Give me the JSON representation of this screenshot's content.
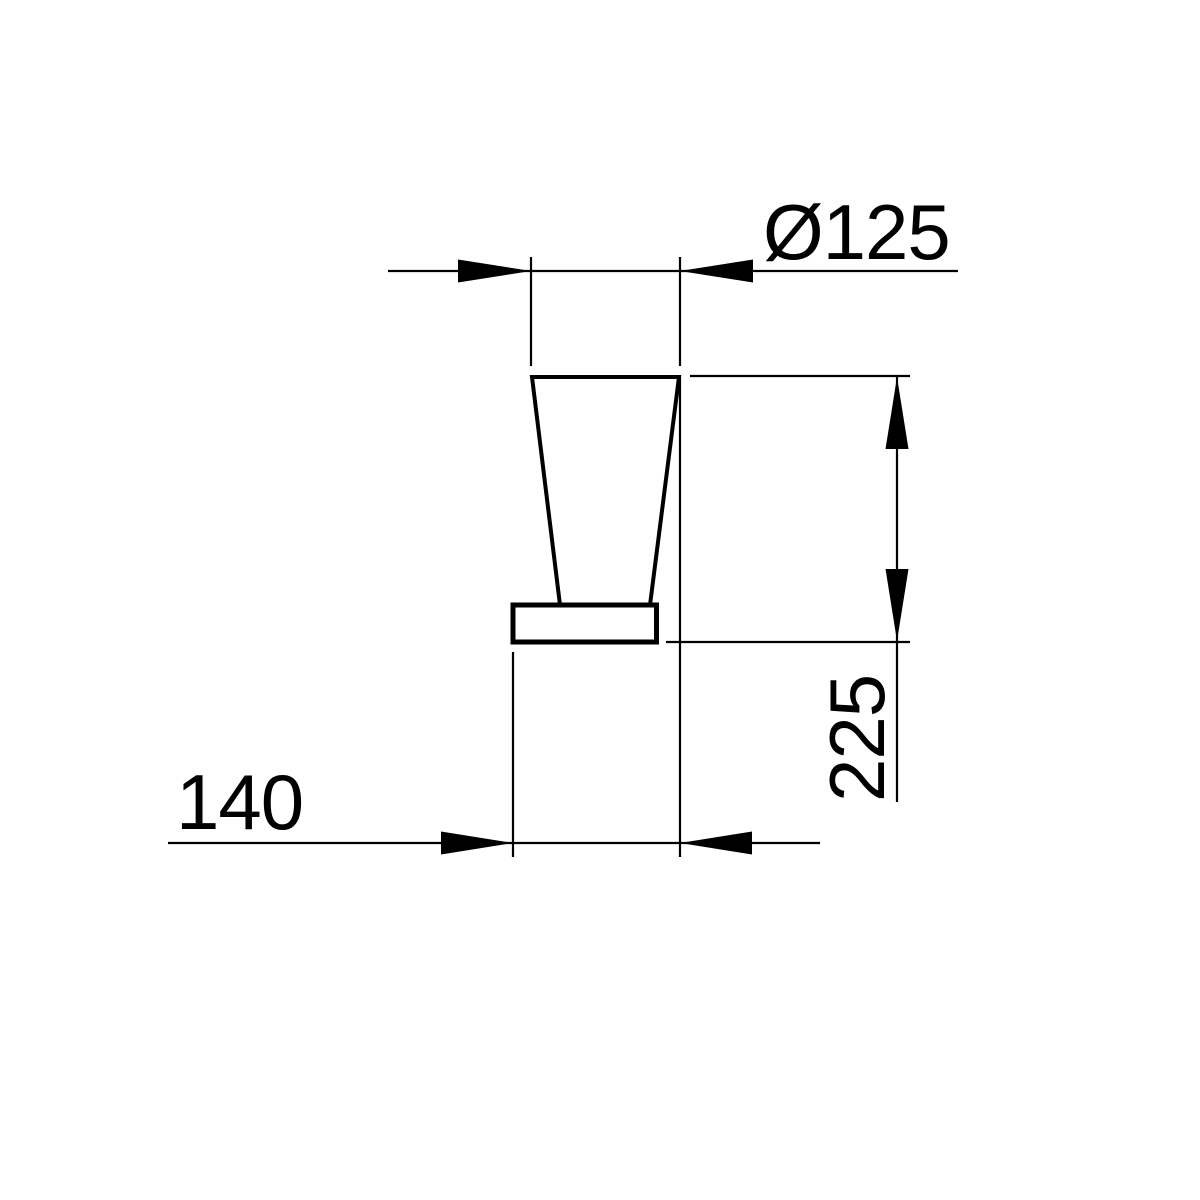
{
  "drawing": {
    "background_color": "#ffffff",
    "line_color": "#000000",
    "dimensions": {
      "diameter": {
        "label": "Ø125",
        "value": 125
      },
      "height": {
        "label": "225",
        "value": 225
      },
      "depth": {
        "label": "140",
        "value": 140
      }
    }
  }
}
